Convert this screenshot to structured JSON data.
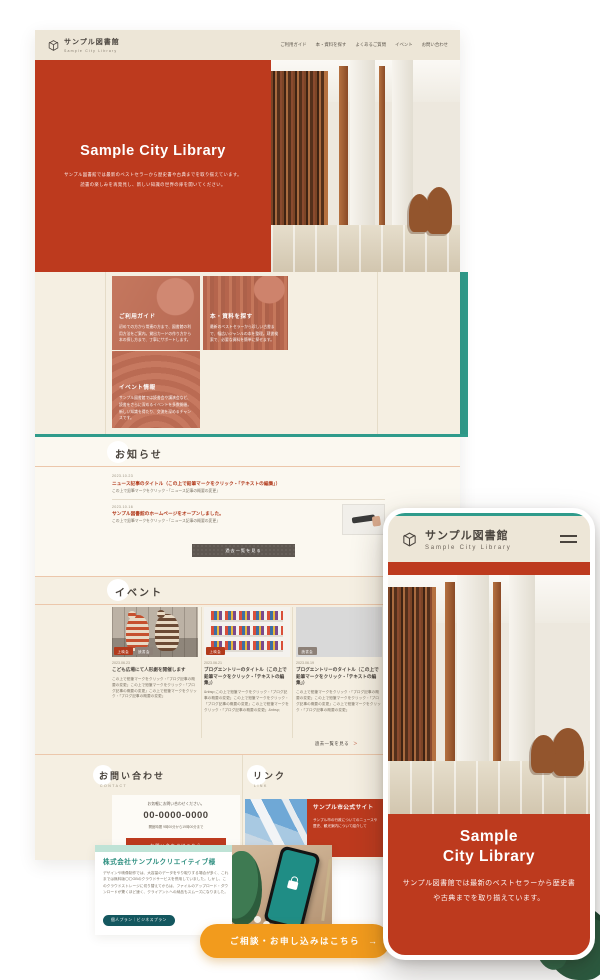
{
  "colors": {
    "accent_red": "#BD3A1E",
    "header_cream": "#EDE6D7",
    "page_cream": "#F5EFE2",
    "teal_accent": "#2F9B8B",
    "cta_orange": "#F29B1D",
    "link_red": "#B23A1C",
    "badge_teal": "#14575F",
    "tag_gray": "#8D8178"
  },
  "desktop": {
    "header": {
      "logo_title": "サンプル図書館",
      "logo_subtitle": "Sample City Library",
      "nav": [
        "ご利用ガイド",
        "本・資料を探す",
        "よくあるご質問",
        "イベント",
        "お問い合わせ"
      ]
    },
    "hero": {
      "title": "Sample City Library",
      "subtitle_1": "サンプル図書館では最新のベストセラーから歴史書や古典までを取り揃えています。",
      "subtitle_2": "読書の楽しみを再発見し、新しい知識の世界の扉を開いてください。"
    },
    "features": [
      {
        "title": "ご利用ガイド",
        "body": "初めての方から常連の方まで、図書館の利用方法をご案内。貸出カードの作り方から本の探し方まで、丁寧にサポートします。"
      },
      {
        "title": "本・資料を探す",
        "body": "最新のベストセラーから珍しい古書まで、幅広いジャンルの本を整理。蔵書検索で、必要な資料を簡単に探せます。"
      },
      {
        "title": "イベント情報",
        "body": "サンプル図書館では読書会や講演会など、読書をさらに深めるイベントを多数開催。新しい知識を得たり、交流を深めるチャンスです。"
      }
    ],
    "news": {
      "heading": "お知らせ",
      "items": [
        {
          "date": "2023.10.23",
          "title": "ニュース記事のタイトル（この上で鉛筆マークをクリック・「テキストの編集」）",
          "summary": "この上で鉛筆マークをクリック・「ニュース記事の概要の変更」"
        },
        {
          "date": "2023.10.16",
          "title": "サンプル図書館のホームページをオープンしました。",
          "summary": "この上で鉛筆マークをクリック・「ニュース記事の概要の変更」"
        }
      ],
      "more_button": "過去一覧を見る"
    },
    "events": {
      "heading": "イベント",
      "cards": [
        {
          "date": "2023.06.23",
          "tags": [
            "上映会",
            "読書会"
          ],
          "title": "こども広場にて人形劇を開催します",
          "body": "この上で鉛筆マークをクリック・「ブログ記事の概要の変更」この上で鉛筆マークをクリック・「ブログ記事の概要の変更」この上で鉛筆マークをクリック・「ブログ記事の概要の変更」"
        },
        {
          "date": "2023.06.21",
          "tags": [
            "上映会"
          ],
          "title": "ブログエントリーのタイトル（この上で鉛筆マークをクリック・「テキストの編集」）",
          "body": "&nbsp;この上で鉛筆マークをクリック・「ブログ記事の概要の変更」この上で鉛筆マークをクリック・「ブログ記事の概要の変更」この上で鉛筆マークをクリック・「ブログ記事の概要の変更」&nbsp;"
        },
        {
          "date": "2023.06.19",
          "tags": [
            "読書会"
          ],
          "title": "ブログエントリーのタイトル（この上で鉛筆マークをクリック・「テキストの編集」）",
          "body": "この上で鉛筆マークをクリック・「ブログ記事の概要の変更」この上で鉛筆マークをクリック・「ブログ記事の概要の変更」この上で鉛筆マークをクリック・「ブログ記事の概要の変更」"
        }
      ],
      "more_label": "過去一覧を見る",
      "more_chevron": "＞"
    },
    "contact": {
      "heading": "お問い合わせ",
      "heading_en": "CONTACT",
      "note": "お気軽にお問い合わせください。",
      "phone": "00-0000-0000",
      "hours": "開館時間 9時00分から19時00分まで",
      "button": "お問い合わせはこちら"
    },
    "links": {
      "heading": "リンク",
      "heading_en": "LINK",
      "card_title": "サンプル市公式サイト",
      "card_body": "サンプル市の行政についてのニュースや歴史、観光案内について紹介して"
    }
  },
  "testimonial": {
    "heading": "株式会社サンプルクリエイティブ様",
    "body": "デザインや映像制作では、大容量のデータをやり取りする場合が多く、これまでは無料版〇〇GBのクラウドサービスを併用していました。しかし、このクラウドストレージに切り替えてからは、ファイルのアップロード・ダウンロードが驚くほど速く、クライアントへの納品もスムーズになりました。",
    "badge": "個人プラン｜ビジネスプラン"
  },
  "cta": {
    "label": "ご相談・お申し込みはこちら",
    "arrow": "→"
  },
  "mobile": {
    "logo_title": "サンプル図書館",
    "logo_subtitle": "Sample City Library",
    "hero_title_1": "Sample",
    "hero_title_2": "City Library",
    "hero_body": "サンプル図書館では最新のベストセラーから歴史書や古典までを取り揃えています。"
  }
}
